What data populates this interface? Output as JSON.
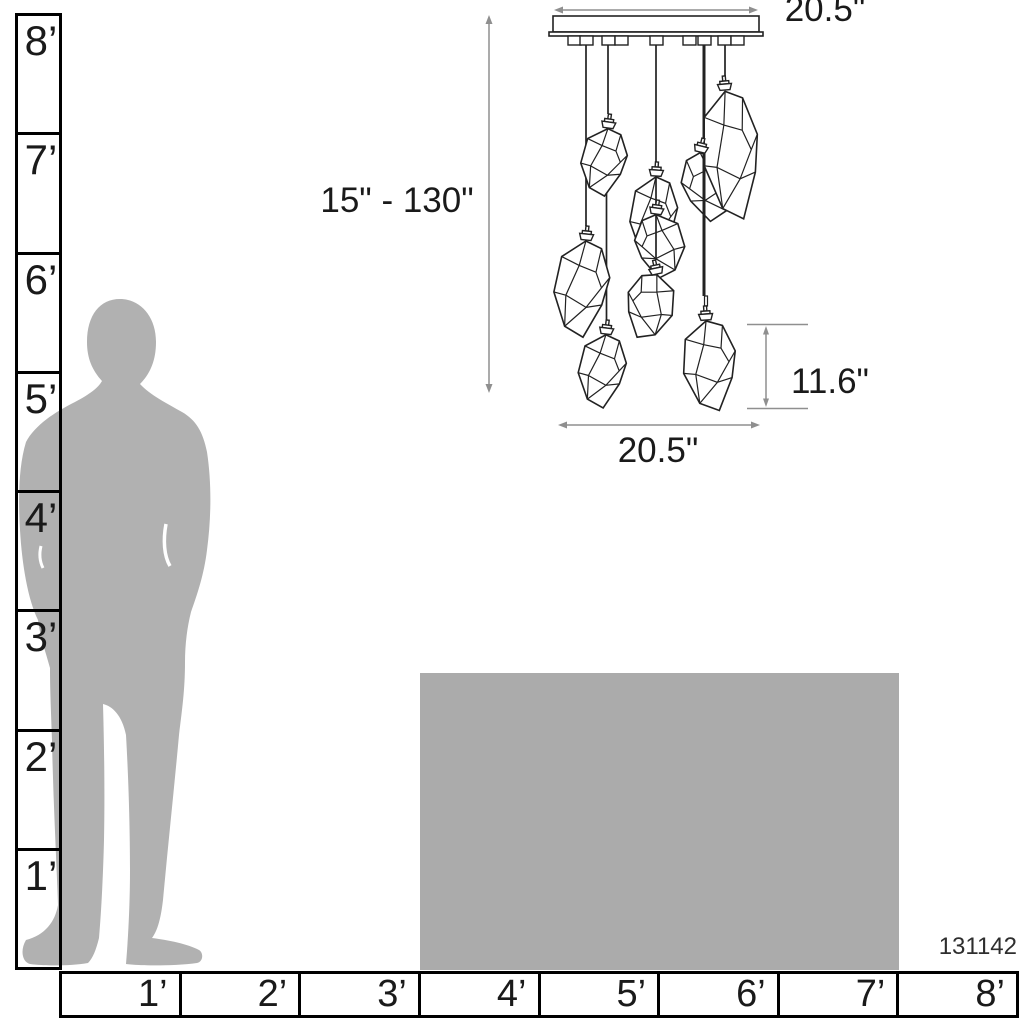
{
  "title": "Pendant chandelier dimension diagram with human scale reference",
  "product": {
    "id": "131142"
  },
  "fixture": {
    "type": "multi-light pendant chandelier with faceted gem glass shades",
    "shade_count": 9,
    "canopy_width_label": "20.5\"",
    "height_range_label": "15\" - 130\"",
    "shade_height_label": "11.6\"",
    "spread_width_label": "20.5\""
  },
  "rulers": {
    "unit": "feet",
    "vertical_feet": [
      "8’",
      "7’",
      "6’",
      "5’",
      "4’",
      "3’",
      "2’",
      "1’"
    ],
    "horizontal_feet": [
      "1’",
      "2’",
      "3’",
      "4’",
      "5’",
      "6’",
      "7’",
      "8’"
    ]
  },
  "scale_references": {
    "figure": "standing man silhouette",
    "furniture": "table height block"
  },
  "colors": {
    "silhouette": "#b1b1b1",
    "table": "#ababab",
    "dimension_lines": "#8f8f8f",
    "linework": "#222222",
    "ruler_lines": "#000000",
    "text": "#1a1a1a"
  }
}
